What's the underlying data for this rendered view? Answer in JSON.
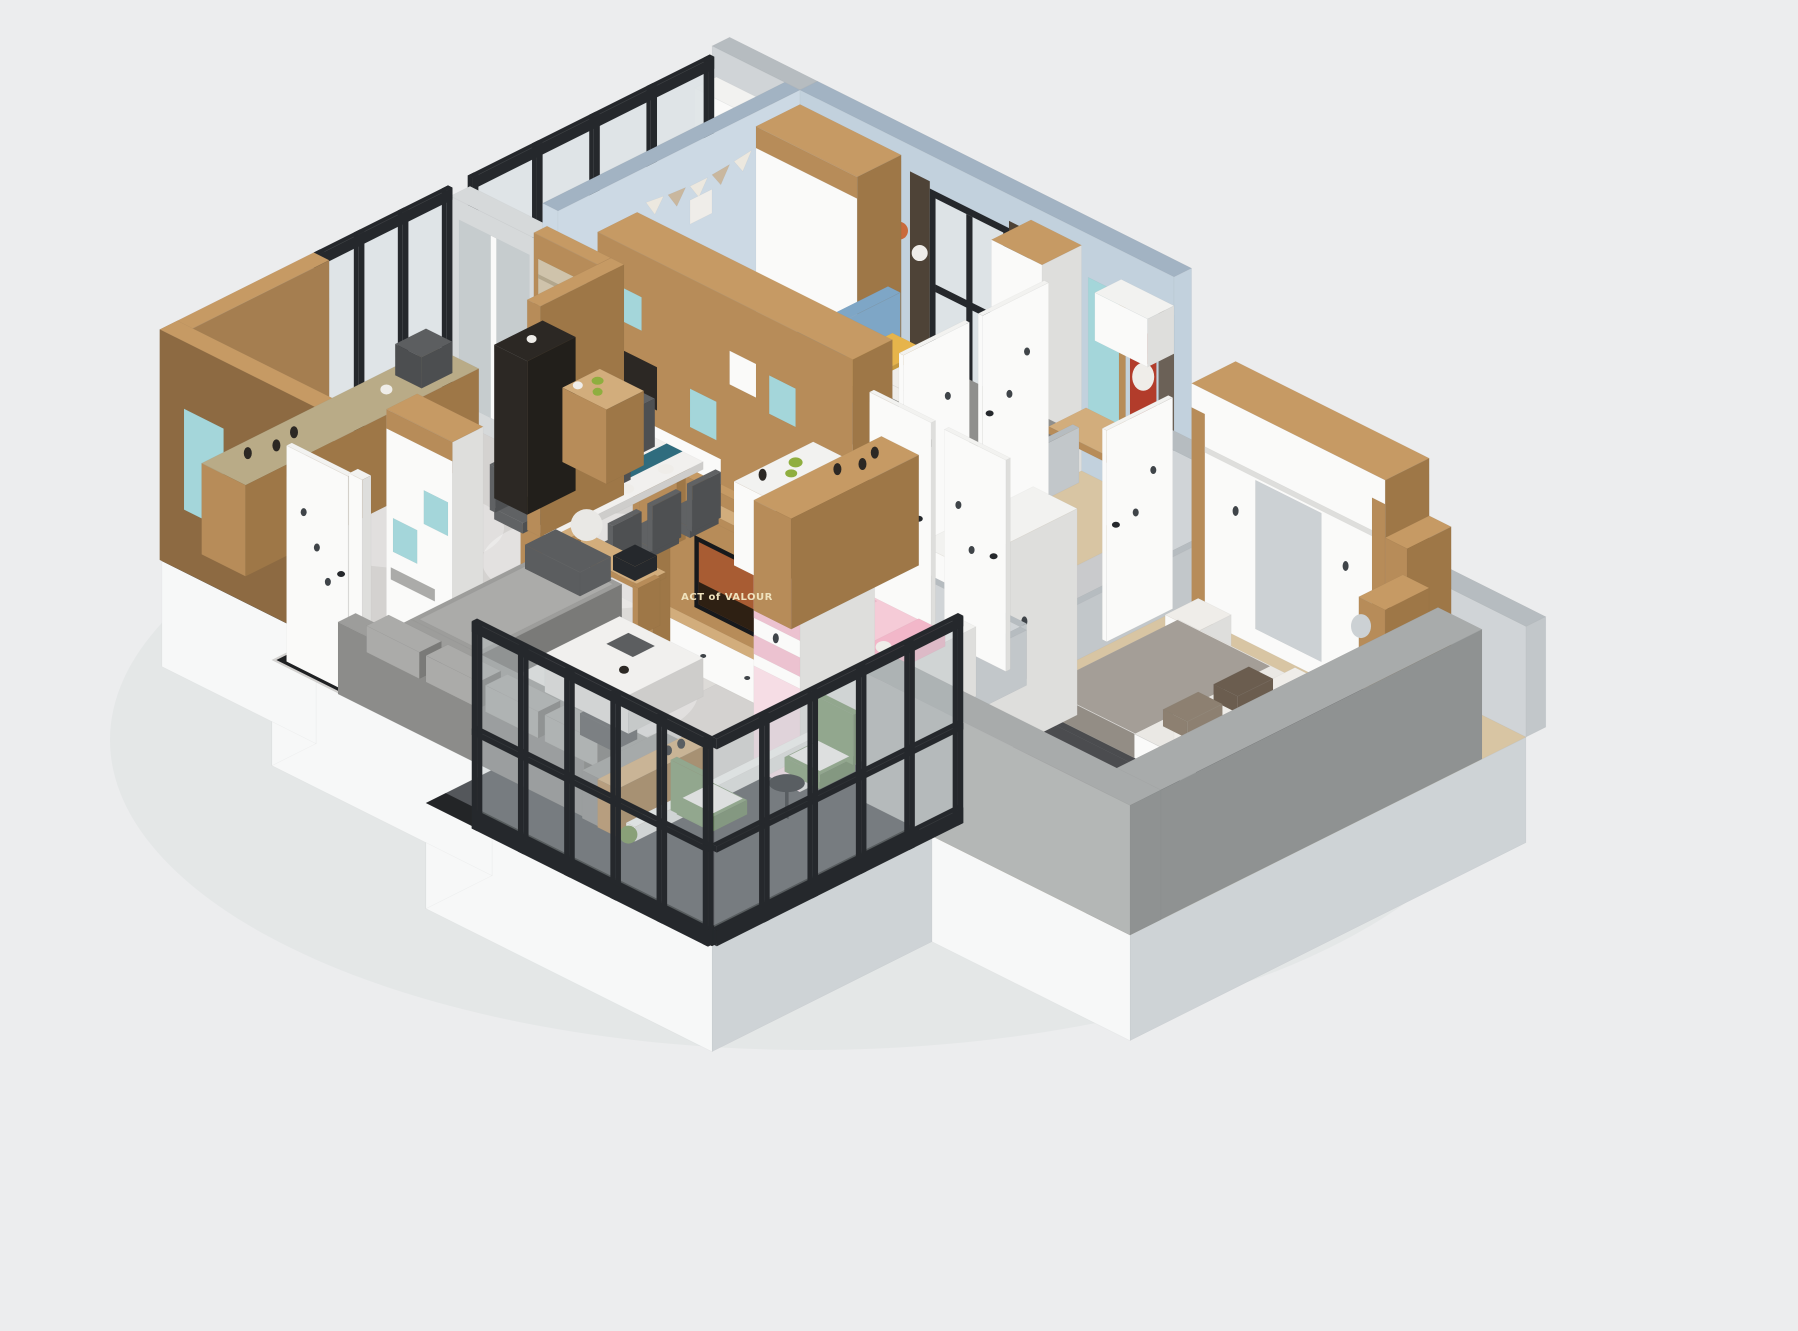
{
  "tv": {
    "poster_title": "ACT of VALOUR"
  },
  "palette": {
    "bg": "#ecedee",
    "shadow": "#e0e2e3",
    "slabTop": "#e3e5e6",
    "slabLight": "#f7f8f8",
    "slabSide": "#ced3d6",
    "floorWood": "#d8c5a3",
    "floorMarble": "#d4d2d0",
    "floorHall": "#c9cacc",
    "floorLaundry": "#eae9e5",
    "floorBalcony": "#54575b",
    "balconyBorder": "#232527",
    "blackMarble": "#1f2123",
    "rugLiving": "#dddbd8",
    "rugCircle": "#c6c4c2",
    "rugMaster": "#a09f9e",
    "wallBlueTop": "#a2b3c3",
    "wallBlueA": "#ccd9e4",
    "wallBlueB": "#c2d1dd",
    "wallGrayTop": "#b6bcc0",
    "wallGrayA": "#d0d4d7",
    "wallGrayB": "#c2c7ca",
    "concreteTop": "#a8abab",
    "concreteB": "#b4b7b6",
    "concreteA": "#8f9292",
    "woodTop": "#c69a64",
    "woodB": "#b78c59",
    "woodA": "#9e7747",
    "woodLight": "#d2ad7c",
    "woodPanel": "#a57e50",
    "woodPanelDark": "#8d6a42",
    "whiteTop": "#f2f2f0",
    "whiteB": "#fafaf9",
    "whiteA": "#dededc",
    "steel": "#25282c",
    "glass": "#dde3e6",
    "glassDark": "#b9c2c6",
    "glassCab": "#3c4044",
    "glassShine": "#aeb6ba",
    "mirror": "#ccd1d4",
    "doorGray": "#d6d9da",
    "teal": "#a4d6da",
    "runnerTeal": "#2f6c7e",
    "sofaTop": "#9d9d9b",
    "sofaB": "#8c8c8a",
    "sofaA": "#7a7a78",
    "cushion": "#ababa9",
    "pillowDark": "#5b5d5f",
    "bedFrame": "#4b4c4f",
    "bedFrameDark": "#3e3f42",
    "sheet": "#eae8e4",
    "knit": "#a49e97",
    "knitDark": "#938d85",
    "pillowWhite": "#efede9",
    "pillowBrown": "#6b5d4f",
    "pillowTan": "#8d8071",
    "headboardBlue": "#7ea6c6",
    "duvetBoys": "#8f8f8d",
    "duvetDark": "#7b7b79",
    "yellow": "#e6b44b",
    "yellowDark": "#c79a3e",
    "pinkBed": "#f5cbd7",
    "pinkDeep": "#efb9ca",
    "pinkPillow": "#f2b7c9",
    "pinkWard": "#ecc2d0",
    "pinkLight": "#f6dde5",
    "greenChair": "#7d9970",
    "greenDark": "#68825c",
    "greenSeat": "#f1f0ed",
    "marble": "#f1f0ee",
    "marbleB": "#e0dfdd",
    "marbleA": "#cecdcb",
    "tvBlack": "#17191c",
    "poster": "#a85c33",
    "posterDark": "#2e2013",
    "posterRed": "#b23c2b",
    "starOrange": "#c96a3c",
    "granite": "#b9ab87",
    "counterDark": "#4a4038",
    "darkCab": "#2c2824",
    "darkCabA": "#221f1b",
    "darkGray": "#5c5e60",
    "darkGrayA": "#4c4e50",
    "plant": "#6f8f4f",
    "fruitGreen": "#8fae3f",
    "blind": "#cfc3ab",
    "blindLine": "#b3a78d",
    "blind2": "#6b6157",
    "curtain": "#4e4337",
    "leaf": "#3f4449",
    "chairYellow": "#e2a93c",
    "chairDark": "#606264",
    "chairDarker": "#4e5052",
    "lampWhite": "#e9e8e5",
    "flagWhite": "#ece8df",
    "flagTan": "#c9b79e",
    "washerDoor": "#8d9296",
    "lampGlow": "#ffffff"
  }
}
